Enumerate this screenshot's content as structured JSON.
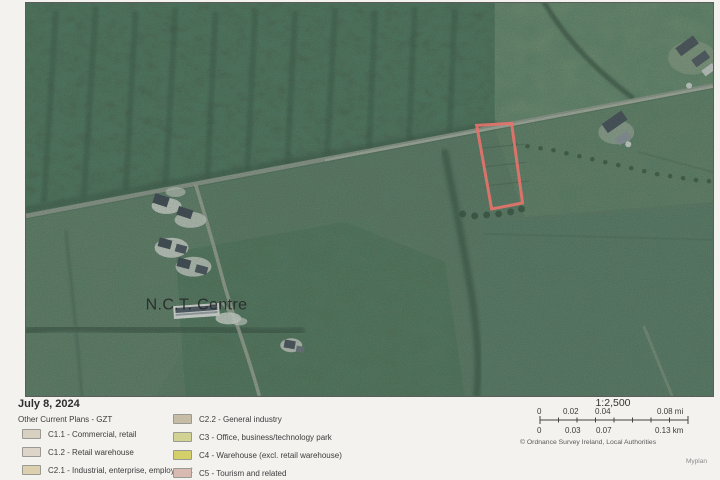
{
  "header": {
    "date": "July 8, 2024"
  },
  "map": {
    "nct_label": "N.C.T. Centre",
    "plot_color": "#e5736b"
  },
  "legend": {
    "title": "Other Current Plans - GZT",
    "left": [
      {
        "code": "C1.1",
        "label": "C1.1 - Commercial, retail",
        "color": "#d8d1c2"
      },
      {
        "code": "C1.2",
        "label": "C1.2 - Retail warehouse",
        "color": "#dcd5c8"
      },
      {
        "code": "C2.1",
        "label": "C2.1 - Industrial, enterprise, employment",
        "color": "#ddd0ae"
      }
    ],
    "right": [
      {
        "code": "C2.2",
        "label": "C2.2 - General industry",
        "color": "#c7bda7"
      },
      {
        "code": "C3",
        "label": "C3 - Office, business/technology park",
        "color": "#d2d392"
      },
      {
        "code": "C4",
        "label": "C4 - Warehouse (excl. retail warehouse)",
        "color": "#d5cf6a"
      },
      {
        "code": "C5",
        "label": "C5 - Tourism and related",
        "color": "#d9bab0"
      }
    ]
  },
  "scalebar": {
    "ratio": "1:2,500",
    "mi": [
      "0",
      "0.02",
      "0.04",
      "0.08 mi"
    ],
    "km": [
      "0",
      "0.03",
      "0.07",
      "0.13 km"
    ],
    "copyright": "© Ordnance Survey Ireland, Local Authorities"
  },
  "footer": {
    "brand": "Myplan"
  }
}
